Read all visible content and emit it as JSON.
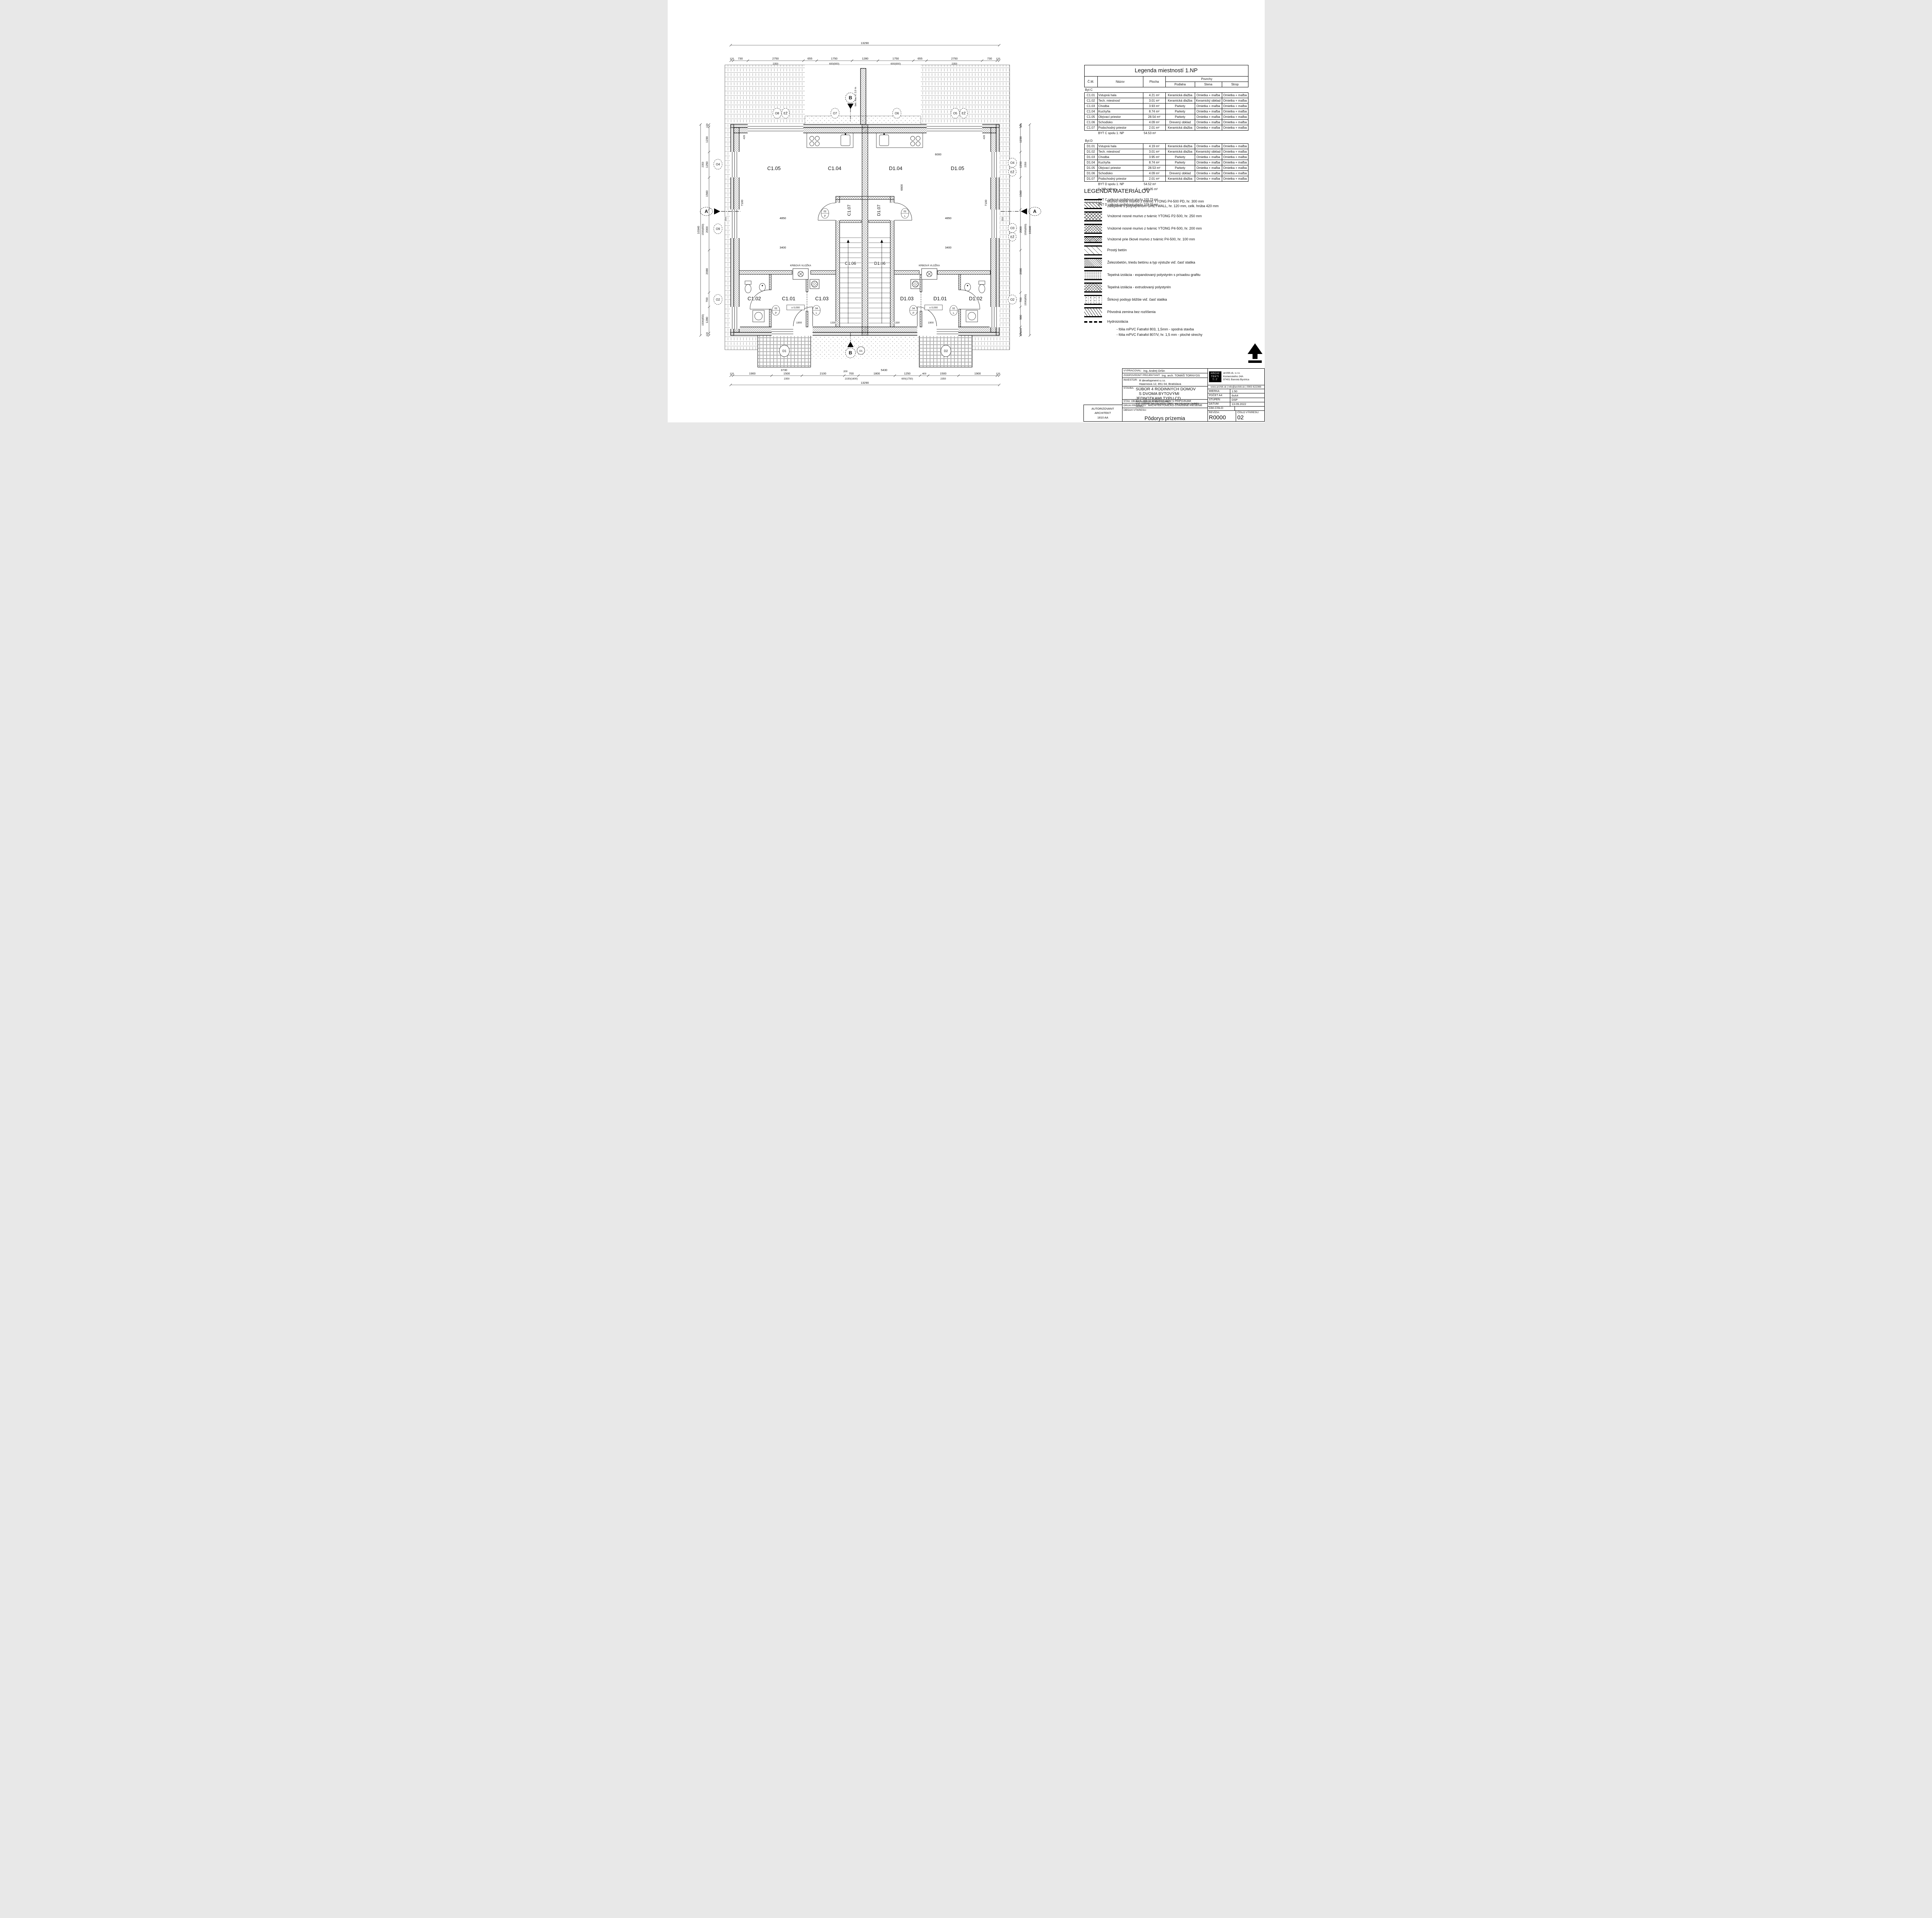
{
  "legend_rooms": {
    "title": "Legenda miestností 1.NP",
    "col_cm": "Č.M.",
    "col_name": "Názov",
    "col_area": "Plocha",
    "col_surfaces": "Povrchy",
    "col_floor": "Podlaha",
    "col_wall": "Stena",
    "col_ceiling": "Strop",
    "byt_c_label": "Byt C",
    "byt_c_rows": [
      {
        "cm": "C1.01",
        "name": "Vstupná hala",
        "area": "4.21 m²",
        "floor": "Keramická dlažba",
        "wall": "Omietka + maľba",
        "ceil": "Omietka + maľba"
      },
      {
        "cm": "C1.02",
        "name": "Tech. miestnosť",
        "area": "3.01 m²",
        "floor": "Keramická dlažba",
        "wall": "Keramický obklad",
        "ceil": "Omietka + maľba"
      },
      {
        "cm": "C1.03",
        "name": "Chodba",
        "area": "3.93 m²",
        "floor": "Parkety",
        "wall": "Omietka + maľba",
        "ceil": "Omietka + maľba"
      },
      {
        "cm": "C1.04",
        "name": "Kuchyňa",
        "area": "8.74 m²",
        "floor": "Parkety",
        "wall": "Omietka + maľba",
        "ceil": "Omietka + maľba"
      },
      {
        "cm": "C1.05",
        "name": "Obývací priestor",
        "area": "28.54 m²",
        "floor": "Parkety",
        "wall": "Omietka + maľba",
        "ceil": "Omietka + maľba"
      },
      {
        "cm": "C1.06",
        "name": "Schodisko",
        "area": "4.09 m²",
        "floor": "Drevený obklad",
        "wall": "Omietka + maľba",
        "ceil": "Omietka + maľba"
      },
      {
        "cm": "C1.07",
        "name": "Podschodný priestor",
        "area": "2.01 m²",
        "floor": "Keramická dlažba",
        "wall": "Omietka + maľba",
        "ceil": "Omietka + maľba"
      }
    ],
    "byt_c_total_name": "BYT C spolu 1. NP",
    "byt_c_total_area": "54.53 m²",
    "byt_d_label": "Byt D",
    "byt_d_rows": [
      {
        "cm": "D1.01",
        "name": "Vstupná hala",
        "area": "4.19 m²",
        "floor": "Keramická dlažba",
        "wall": "Omietka + maľba",
        "ceil": "Omietka + maľba"
      },
      {
        "cm": "D1.02",
        "name": "Tech. miestnosť",
        "area": "3.01 m²",
        "floor": "Keramická dlažba",
        "wall": "Keramický obklad",
        "ceil": "Omietka + maľba"
      },
      {
        "cm": "D1.03",
        "name": "Chodba",
        "area": "3.95 m²",
        "floor": "Parkety",
        "wall": "Omietka + maľba",
        "ceil": "Omietka + maľba"
      },
      {
        "cm": "D1.04",
        "name": "Kuchyňa",
        "area": "8.74 m²",
        "floor": "Parkety",
        "wall": "Omietka + maľba",
        "ceil": "Omietka + maľba"
      },
      {
        "cm": "D1.05",
        "name": "Obývací priestor",
        "area": "28.53 m²",
        "floor": "Parkety",
        "wall": "Omietka + maľba",
        "ceil": "Omietka + maľba"
      },
      {
        "cm": "D1.06",
        "name": "Schodisko",
        "area": "4.09 m²",
        "floor": "Drevený obklad",
        "wall": "Omietka + maľba",
        "ceil": "Omietka + maľba"
      },
      {
        "cm": "D1.07",
        "name": "Podschodný priestor",
        "area": "2.01 m²",
        "floor": "Keramická dlažba",
        "wall": "Omietka + maľba",
        "ceil": "Omietka + maľba"
      }
    ],
    "byt_d_total_name": "BYT D spolu 1. NP",
    "byt_d_total_area": "54.52 m²",
    "np_total_name": "1. NP celkom",
    "np_total_area": "109.05 m²",
    "byt_c_area_name": "BYT C celková podlahová plocha",
    "byt_c_area_val": "103.73 m²",
    "byt_d_area_name": "BYT D celková podlahová plocha",
    "byt_d_area_val": "103.72 m²"
  },
  "materials": {
    "title": "LEGENDA MATERIÁLOV",
    "items": [
      {
        "kind": "ytong-eps",
        "l1": "Murivo nosné murivo z tvárnic YTONG P4-500 PD, hr. 300 mm",
        "l2": "zateplené s polystyrénom GREYWALL, hr. 120 mm, celk. hrúba 420 mm"
      },
      {
        "kind": "cross250",
        "l1": "Vnútorné nosné murivo z tvárnic YTONG P2-500, hr. 250 mm"
      },
      {
        "kind": "cross200",
        "l1": "Vnútorné nosné murivo z tvárnic YTONG P4-500, hr. 200 mm"
      },
      {
        "kind": "cross100",
        "l1": "Vnútorné prie čkové murivo z tvárnic P4-500, hr. 100 mm"
      },
      {
        "kind": "plainc",
        "l1": "Prostý betón"
      },
      {
        "kind": "rc",
        "l1": "Železobetón, triedu betónu a typ výstuže viď. časť statika"
      },
      {
        "kind": "eps",
        "l1": "Tepelná izolácia - expandovaný polystyrén s prísadou grafitu"
      },
      {
        "kind": "xps",
        "l1": "Tepelná izolácia - extrudovaný polystyrén"
      },
      {
        "kind": "gravel",
        "l1": "Štrkový podsyp bližšie viď. časť statika"
      },
      {
        "kind": "soil",
        "l1": "Pôvodná zemina bez rozlíšenia"
      }
    ],
    "hydro_label": "Hydroizolácia",
    "hydro_line1": "- fólia mPVC Fatrafol 803, 1,5mm - spodná stavba",
    "hydro_line2": "- fólia mPVC Fatrafol 807/V, hr. 1,5 mm - ploché strechy"
  },
  "title_block": {
    "vypracoval_label": "VYPRACOVAL:",
    "vypracoval": "Ing. Andrej Oršin",
    "zodp_label": "ZODPOVEDNÝ PROJEKTANT:",
    "zodp": "Ing. arch. TOMÁŠ TORNYOS",
    "investor_label": "INVESTOR:",
    "investor1": "R development s.r.o.",
    "investor2": "Haannova 12, 851 04, Bratislava",
    "stavba_label": "STAVBA:",
    "stavba1": "SÚBOR 4 RODINNÝCH DOMOV",
    "stavba2": "S DVOMA BYTOVÝMI JEDNOTKAMI TYPU CD",
    "parcely": "NA PARCELÁCH: KN-C 133/461",
    "kat": "KAT. ÚZEMIE: MILOSLAVOV, OBEC: MILOSLAVOV, OKRES: SENEC",
    "objekt_label": "STAV. OBJEKT:",
    "objekt": "SO-01 RODINNÝ DOM S PRÍPOJKAMI",
    "druh_label": "DRUH PROJEKTU:",
    "druh": "ARCHITEKTONICKO-STAVEBNÉ RIEŠENIE",
    "obsah_label": "OBSAH VÝKRESU:",
    "obsah": "Pôdorys prízemia",
    "auth1": "AUTORIZOVANÝ ARCHITEKT",
    "auth2": "1810 AA",
    "logo1": "ARCHI",
    "logo2": "TEKTI",
    "logo3": "T∴T",
    "firm1": "architt.sk, s.r.o.",
    "firm2": "Komenského 24A",
    "firm3": "97401 Banská Bystrica",
    "contact": "www.architt.sk | info@architt.sk | 0903 622366",
    "mierka_label": "MIERKA:",
    "mierka": "1:50",
    "pocet_label": "POČET A4:",
    "pocet": "6xA4",
    "stupen_label": "STUPEŇ:",
    "stupen": "DSP",
    "datum_label": "DÁTUM:",
    "datum": "13.09.2022",
    "zak_label": "ZÁK.ČÍSLO:",
    "zak": "",
    "rev_label": "REVÍZIA:",
    "rev": "R0000",
    "cislo_label": "ČÍSLO VÝKRESU:",
    "cislo": "02"
  },
  "plan": {
    "top_total": "13290",
    "top_chain": [
      "120",
      "730",
      "2750",
      "655",
      "1750",
      "1280",
      "1750",
      "655",
      "2750",
      "730",
      "120"
    ],
    "top_sub": [
      "2350",
      "600(900)",
      "600(900)",
      "2350"
    ],
    "bottom_chain": [
      "120",
      "1900",
      "1500",
      "2100",
      "700",
      "1800",
      "1250",
      "400",
      "1500",
      "1900",
      "120"
    ],
    "bottom_sub": [
      "2350",
      "2150(1600)",
      "600(1750)",
      "2350"
    ],
    "bottom_total": "13290",
    "left_chain": [
      "120",
      "1230",
      "1250",
      "1560",
      "2000",
      "2080",
      "700",
      "1280",
      "120"
    ],
    "left_sub": [
      "2350",
      "1500(850)",
      "1500(850)"
    ],
    "left_total": "10340",
    "right_chain": [
      "120",
      "1230",
      "1250",
      "1560",
      "2000",
      "2080",
      "700",
      "980",
      "300",
      "120"
    ],
    "right_sub": [
      "2350",
      "1500(850)",
      "1500(850)"
    ],
    "right_total": "10340",
    "rooms": [
      "C1.05",
      "C1.04",
      "D1.04",
      "D1.05",
      "C1.07",
      "D1.07",
      "C1.06",
      "D1.06",
      "C1.02",
      "C1.01",
      "C1.03",
      "D1.03",
      "D1.01",
      "D1.02"
    ],
    "axis_top": [
      "O8",
      "EŽ",
      "O7",
      "O6",
      "O5",
      "EŽ"
    ],
    "axis_left": [
      "O4",
      "O9",
      "O2"
    ],
    "axis_right": [
      "O4",
      "EŽ",
      "O3",
      "EŽ",
      "O2"
    ],
    "axis_o1": "O1",
    "section_a": "A",
    "section_b": "B",
    "terrace": [
      "D1",
      "D2"
    ],
    "fireplace_label": "KRBOVÁ VLOŽKA",
    "wall_note": "bet. múr, v. 2,0 m",
    "level": "± 0,000",
    "door_tags": [
      "02",
      "P",
      "04",
      "L",
      "04",
      "P",
      "02",
      "L",
      "02",
      "P",
      "02",
      "L"
    ],
    "idims": [
      "6000",
      "4850",
      "4850",
      "7100",
      "7100",
      "6600",
      "3400",
      "3400",
      "1900",
      "1330",
      "1330",
      "1900",
      "3730",
      "5430",
      "200",
      "420",
      "420",
      "350",
      "350"
    ]
  }
}
